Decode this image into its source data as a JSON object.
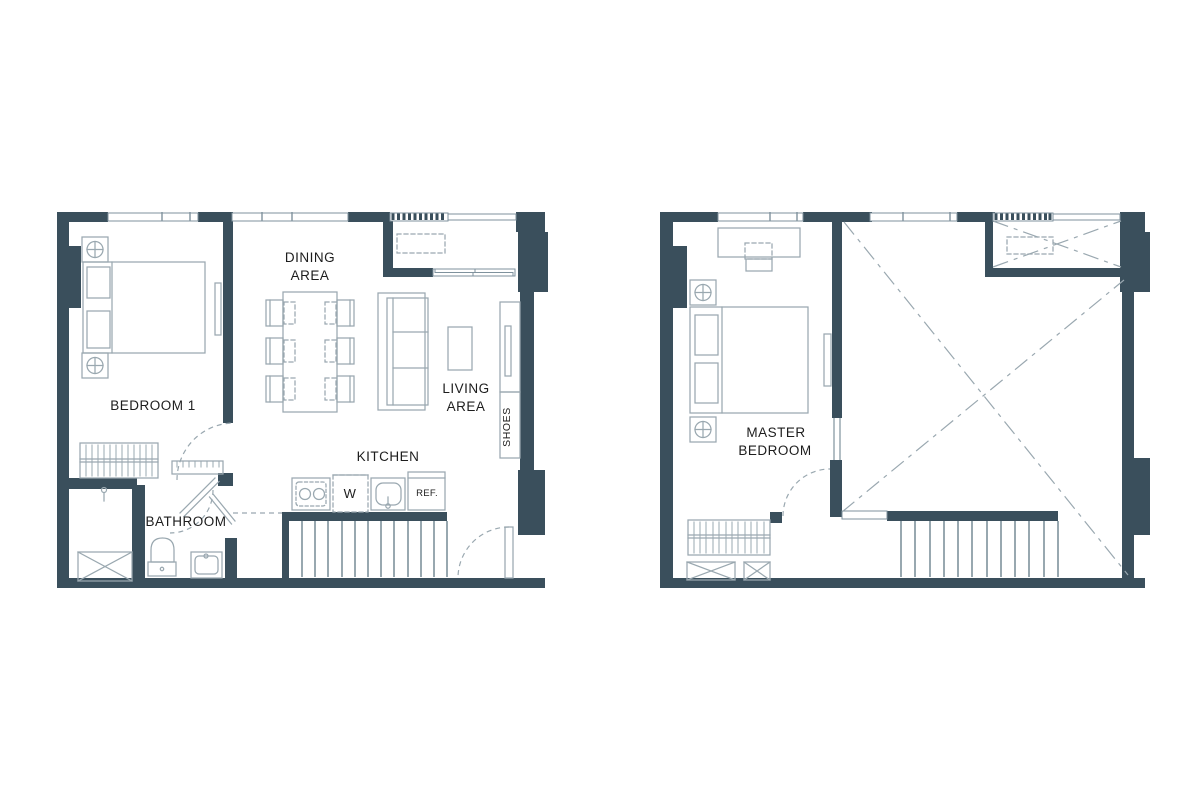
{
  "theme": {
    "background": "#ffffff",
    "wall_color": "#3a4f5c",
    "line_color": "#9aa8b0",
    "line_strong": "#7f929d",
    "text_color": "#1d1d1d"
  },
  "plan_lower": {
    "labels": {
      "bedroom1": "BEDROOM 1",
      "dining_line1": "DINING",
      "dining_line2": "AREA",
      "living_line1": "LIVING",
      "living_line2": "AREA",
      "kitchen": "KITCHEN",
      "washer": "W",
      "fridge": "REF.",
      "bathroom": "BATHROOM",
      "shoes": "SHOES"
    }
  },
  "plan_upper": {
    "labels": {
      "master_line1": "MASTER",
      "master_line2": "BEDROOM"
    }
  }
}
